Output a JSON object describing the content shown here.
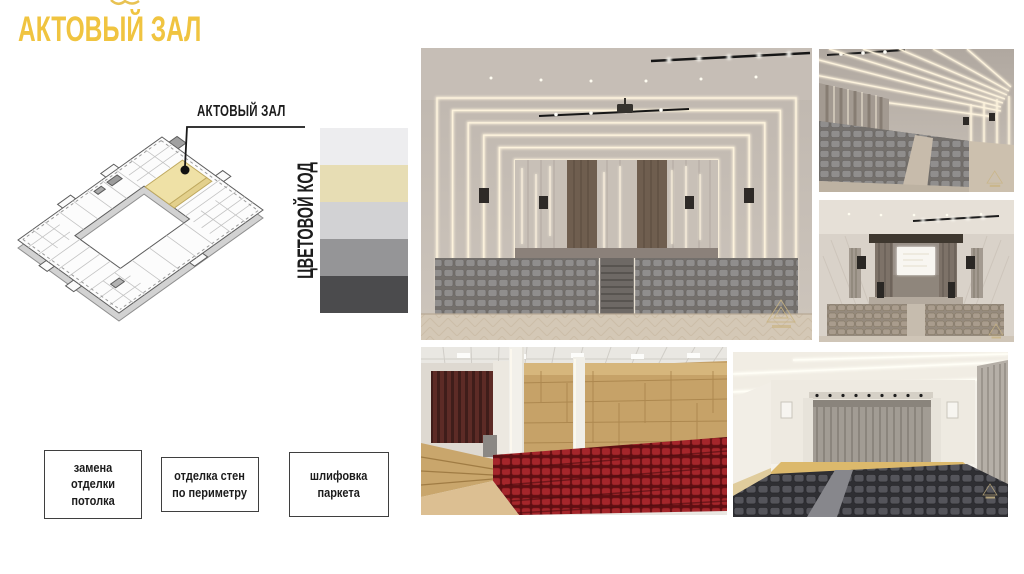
{
  "slide": {
    "title": "АКТОВЫЙ ЗАЛ",
    "accent": "#F0C440",
    "background": "#FFFFFF"
  },
  "plan": {
    "callout_label": "АКТОВЫЙ ЗАЛ",
    "highlight_hex": "#EFE1A6"
  },
  "palette": {
    "title": "ЦВЕТОВОЙ КОД",
    "swatches": [
      {
        "name": "off-white",
        "hex": "#EDEDEF"
      },
      {
        "name": "cream",
        "hex": "#E7DDB4"
      },
      {
        "name": "light-gray",
        "hex": "#D2D2D4"
      },
      {
        "name": "medium-gray",
        "hex": "#959597"
      },
      {
        "name": "dark-gray",
        "hex": "#4B4B4D"
      }
    ]
  },
  "work_notes": [
    {
      "label": "замена\nотделки\nпотолка"
    },
    {
      "label": "отделка стен\nпо периметру"
    },
    {
      "label": "шлифовка\nпаркета"
    }
  ],
  "gallery": {
    "photos": [
      {
        "name": "render-auditorium-rear-view"
      },
      {
        "name": "render-auditorium-side-view"
      },
      {
        "name": "render-stage-screen-view"
      },
      {
        "name": "photo-existing-hall-red-seats"
      },
      {
        "name": "render-hall-dark-seats"
      }
    ]
  }
}
